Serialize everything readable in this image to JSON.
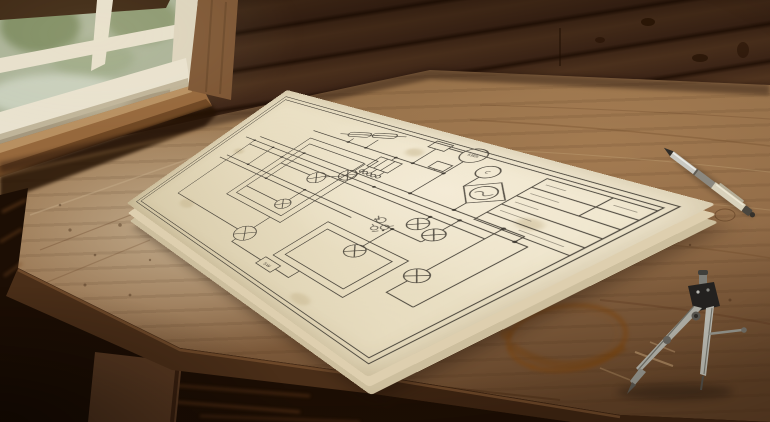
{
  "scene": {
    "description": "Vintage hand-drawn electrical schematic on aged paper, lying on a rustic wooden table beside a window, with a silver pen and a steel drafting compass",
    "schematic": {
      "switch_label": "SW",
      "meter_label": "kWh",
      "generator_label": "C"
    },
    "objects": {
      "paper": "aged schematic drawing sheets",
      "pen": "silver ballpoint pen",
      "compass": "steel drafting compass",
      "stain": "coffee ring stain",
      "window": "window with blurred green foliage view"
    },
    "colors": {
      "wall": "#4e3120",
      "table": "#97724b",
      "paper": "#ece2c9",
      "ink": "#3b362e",
      "stain": "#7a440f"
    }
  }
}
